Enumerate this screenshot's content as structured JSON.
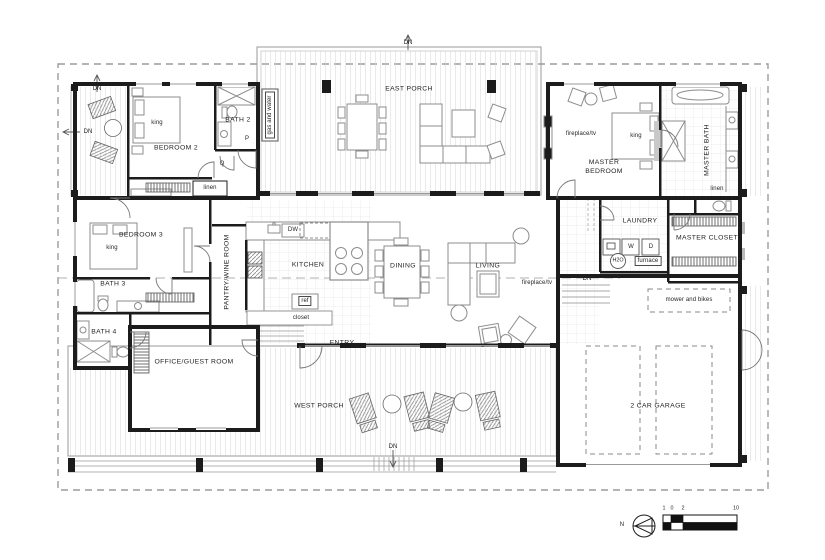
{
  "plan": {
    "rooms": {
      "east_porch": "EAST PORCH",
      "west_porch": "WEST PORCH",
      "entry": "ENTRY",
      "kitchen": "KITCHEN",
      "dining": "DINING",
      "living": "LIVING",
      "pantry_wine": "PANTRY/WINE ROOM",
      "bedroom2": "BEDROOM 2",
      "bedroom3": "BEDROOM 3",
      "bath2": "BATH 2",
      "bath3": "BATH 3",
      "bath4": "BATH 4",
      "office_guest": "OFFICE/GUEST ROOM",
      "laundry": "LAUNDRY",
      "master_bedroom": "MASTER BEDROOM",
      "master_bath": "MASTER BATH",
      "master_closet": "MASTER CLOSET",
      "garage": "2 CAR GARAGE"
    },
    "fixtures": {
      "king_bed": "king",
      "linen": "linen",
      "closet": "closet",
      "fridge": "ref",
      "dishwasher": "DW",
      "washer": "W",
      "dryer": "D",
      "water_heater": "H2O",
      "furnace": "furnace",
      "fireplace_tv": "fireplace/tv",
      "gas_and_water": "gas and water",
      "mower_bikes": "mower and bikes",
      "stair_down": "DN",
      "door_tag_p": "P",
      "door_tag_q": "Q"
    },
    "legend": {
      "north": "N",
      "scale_ticks": [
        "1",
        "0",
        "2",
        "10"
      ]
    },
    "colors": {
      "wall": "#1c1c1c",
      "furniture_line": "#8c8c8c",
      "plank_line": "#d6d6d6",
      "dash_line": "#9c9c9c",
      "background": "#ffffff"
    }
  }
}
